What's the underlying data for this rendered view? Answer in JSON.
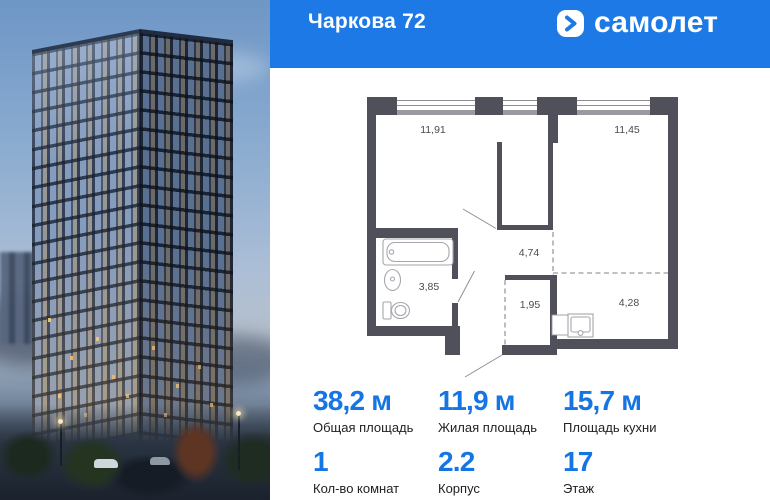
{
  "colors": {
    "header_blue": "#1d79e6",
    "accent_blue": "#1576e3",
    "plan_wall": "#50505a"
  },
  "header": {
    "project_name": "Чаркова 72",
    "logo_text": "самолет",
    "logo_icon": "chevron-right-icon"
  },
  "floor_plan": {
    "room_areas": [
      {
        "name": "living-room",
        "area": "11,91"
      },
      {
        "name": "bedroom",
        "area": "11,45"
      },
      {
        "name": "hallway",
        "area": "4,74"
      },
      {
        "name": "bathroom",
        "area": "3,85"
      },
      {
        "name": "storage",
        "area": "1,95"
      },
      {
        "name": "kitchen",
        "area": "4,28"
      }
    ]
  },
  "stats": {
    "primary": [
      {
        "value": "38,2 м",
        "label": "Общая площадь"
      },
      {
        "value": "11,9 м",
        "label": "Жилая площадь"
      },
      {
        "value": "15,7 м",
        "label": "Площадь кухни"
      }
    ],
    "secondary": [
      {
        "value": "1",
        "label": "Кол-во комнат"
      },
      {
        "value": "2.2",
        "label": "Корпус"
      },
      {
        "value": "17",
        "label": "Этаж"
      }
    ]
  }
}
